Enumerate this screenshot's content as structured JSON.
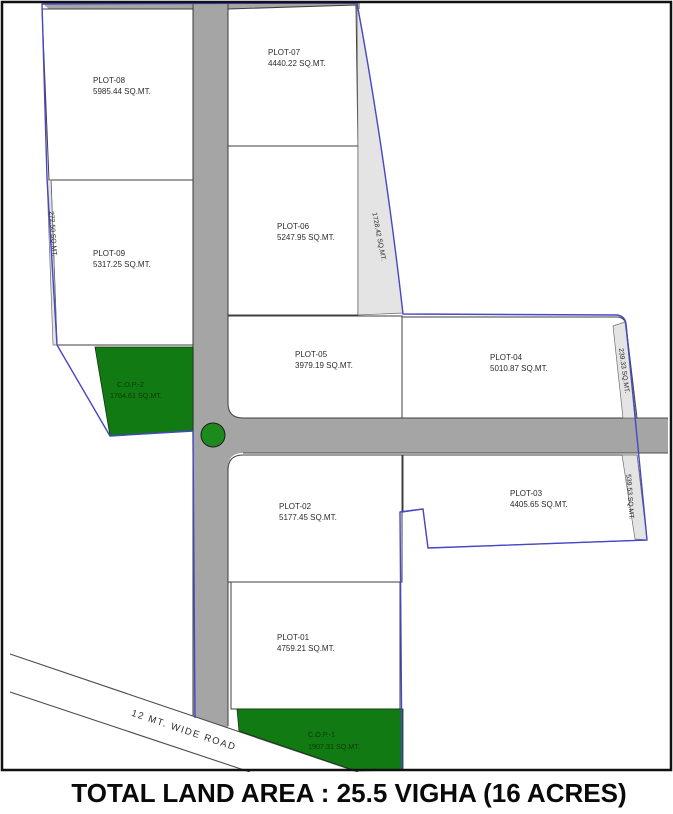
{
  "title": "TOTAL LAND AREA : 25.5 VIGHA (16 ACRES)",
  "road": {
    "label": "12 MT. WIDE ROAD"
  },
  "plots": {
    "p1": {
      "name": "PLOT-01",
      "area": "4759.21 SQ.MT."
    },
    "p2": {
      "name": "PLOT-02",
      "area": "5177.45 SQ.MT."
    },
    "p3": {
      "name": "PLOT-03",
      "area": "4405.65 SQ.MT."
    },
    "p4": {
      "name": "PLOT-04",
      "area": "5010.87 SQ.MT."
    },
    "p5": {
      "name": "PLOT-05",
      "area": "3979.19 SQ.MT."
    },
    "p6": {
      "name": "PLOT-06",
      "area": "5247.95 SQ.MT."
    },
    "p7": {
      "name": "PLOT-07",
      "area": "4440.22 SQ.MT."
    },
    "p8": {
      "name": "PLOT-08",
      "area": "5985.44 SQ.MT."
    },
    "p9": {
      "name": "PLOT-09",
      "area": "5317.25 SQ.MT."
    }
  },
  "open_plots": {
    "c1": {
      "name": "C.O.P.-1",
      "area": "1907.31 SQ.MT."
    },
    "c2": {
      "name": "C.O.P.-2",
      "area": "1764.61 SQ.MT."
    }
  },
  "margin_areas": {
    "left": "272.50 SQ.MT.",
    "center": "1728.42 SQ.MT.",
    "right_upper": "239.33 SQ.MT.",
    "right_lower": "539.53 SQ.MT."
  },
  "colors": {
    "road_gray": "#a5a5a5",
    "boundary_blue": "#4747c7",
    "open_plot_green": "#127a12",
    "sliver_gray": "#e4e4e4"
  }
}
